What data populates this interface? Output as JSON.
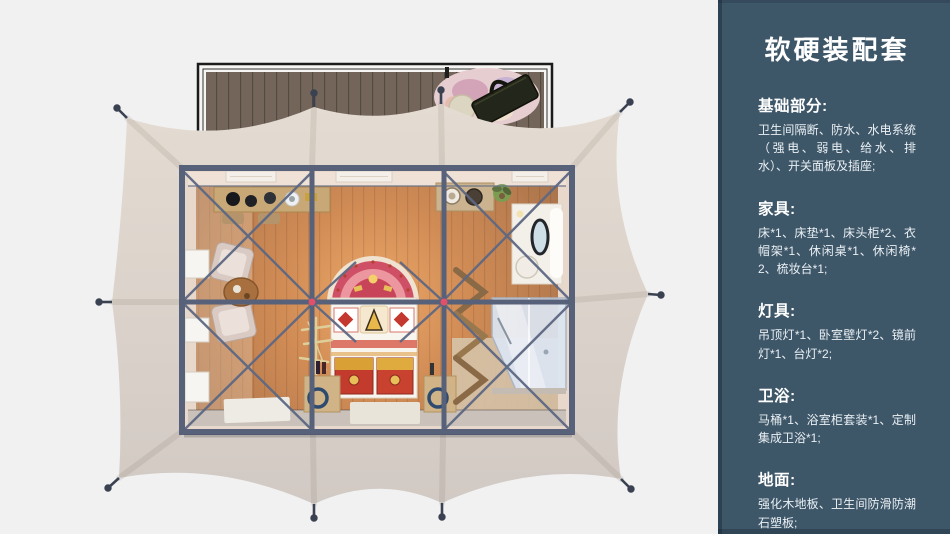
{
  "sidebar": {
    "title": "软硬装配套",
    "sections": [
      {
        "heading": "基础部分:",
        "body": "卫生间隔断、防水、水电系统（强电、弱电、给水、排水）、开关面板及插座;"
      },
      {
        "heading": "家具:",
        "body": "床*1、床垫*1、床头柜*2、衣帽架*1、休闲桌*1、休闲椅*2、梳妆台*1;"
      },
      {
        "heading": "灯具:",
        "body": "吊顶灯*1、卧室壁灯*2、镜前灯*1、台灯*2;"
      },
      {
        "heading": "卫浴:",
        "body": "马桶*1、浴室柜套装*1、定制集成卫浴*1;"
      },
      {
        "heading": "地面:",
        "body": "强化木地板、卫生间防滑防潮石塑板;"
      }
    ]
  },
  "colors": {
    "page_bg": "#f1f1f2",
    "sidebar_bg": "#3d5668",
    "sidebar_text": "#eaf0f4",
    "canopy_light": "#e4dcd2",
    "canopy_dark": "#d0c8c2",
    "deck_wood": "#73655a",
    "wall": "#e8d8cb",
    "frame_steel": "#57617a",
    "joint_accent": "#e0506a",
    "bed_red": "#cf4f66",
    "chest_red": "#c33b2d",
    "chest_gold": "#d9a036",
    "glass": "#dce5f1"
  }
}
